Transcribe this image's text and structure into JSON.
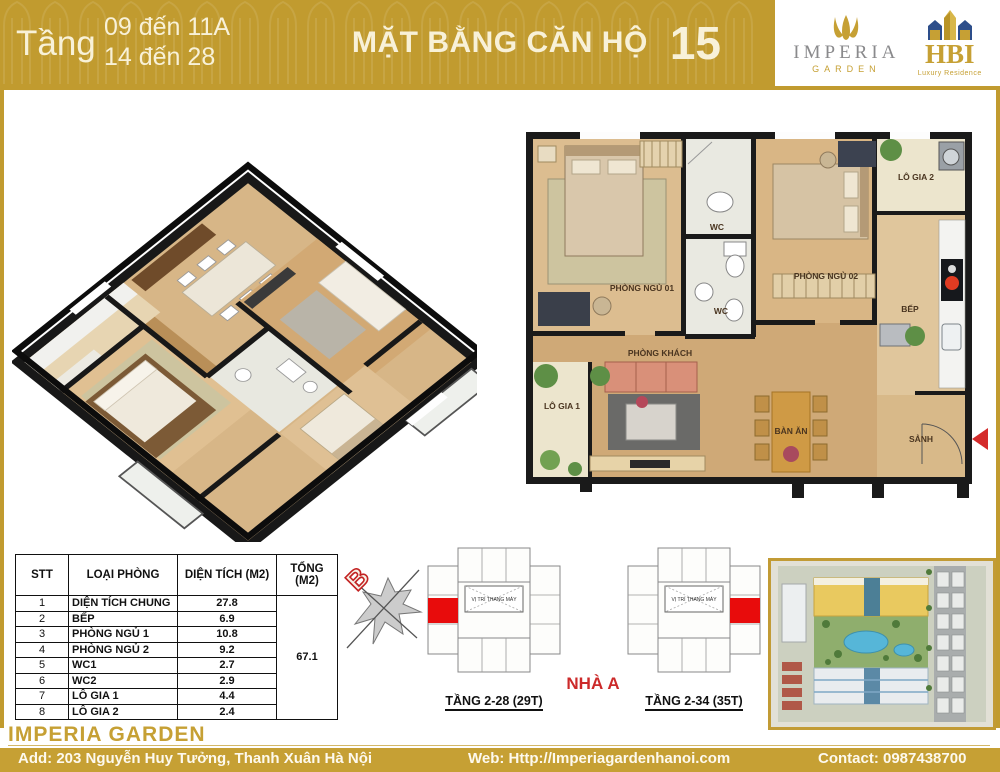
{
  "header": {
    "floor_label": "Tầng",
    "floor_line1": "09 đến 11A",
    "floor_line2": "14 đến 28",
    "title": "MẶT BẰNG CĂN HỘ",
    "unit_number": "15",
    "imperia_logo": {
      "name": "IMPERIA",
      "sub": "GARDEN"
    },
    "hbi_logo": {
      "name": "HBI",
      "sub": "Luxury Residence"
    }
  },
  "area_table": {
    "headers": {
      "stt": "STT",
      "room": "LOẠI PHÒNG",
      "area": "DIỆN TÍCH (M2)",
      "total": "TỔNG (M2)"
    },
    "rows": [
      {
        "stt": "1",
        "room": "DIỆN TÍCH CHUNG",
        "area": "27.8"
      },
      {
        "stt": "2",
        "room": "BẾP",
        "area": "6.9"
      },
      {
        "stt": "3",
        "room": "PHÒNG NGỦ 1",
        "area": "10.8"
      },
      {
        "stt": "4",
        "room": "PHÒNG NGỦ 2",
        "area": "9.2"
      },
      {
        "stt": "5",
        "room": "WC1",
        "area": "2.7"
      },
      {
        "stt": "6",
        "room": "WC2",
        "area": "2.9"
      },
      {
        "stt": "7",
        "room": "LÔ GIA 1",
        "area": "4.4"
      },
      {
        "stt": "8",
        "room": "LÔ GIA 2",
        "area": "2.4"
      }
    ],
    "total": "67.1"
  },
  "plan2d_labels": {
    "bedroom1": "PHÒNG NGỦ 01",
    "bedroom2": "PHÒNG NGỦ 02",
    "wc_top": "WC",
    "wc_bottom": "WC",
    "loggia2": "LÔ GIA 2",
    "kitchen": "BẾP",
    "living": "PHÒNG KHÁCH",
    "loggia1": "LÔ GIA 1",
    "dining": "BÀN ĂN",
    "hall": "SẢNH"
  },
  "keyplans": {
    "compass_label": "B",
    "elevator_label": "VỊ TRÍ THANG MÁY",
    "left_caption": "TẦNG 2-28 (29T)",
    "right_caption": "TẦNG 2-34 (35T)",
    "building_label": "NHÀ A"
  },
  "footer": {
    "brand": "IMPERIA GARDEN",
    "address": "Add: 203 Nguyễn Huy Tưởng, Thanh Xuân Hà Nội",
    "web": "Web: Http://Imperiagardenhanoi.com",
    "contact": "Contact: 0987438700"
  },
  "colors": {
    "gold": "#C19B2F",
    "cream_text": "#F8F1D8",
    "table_value_red": "#C03A3A",
    "accent_red": "#CC2A2A",
    "unit_highlight_red": "#E80C0C"
  }
}
